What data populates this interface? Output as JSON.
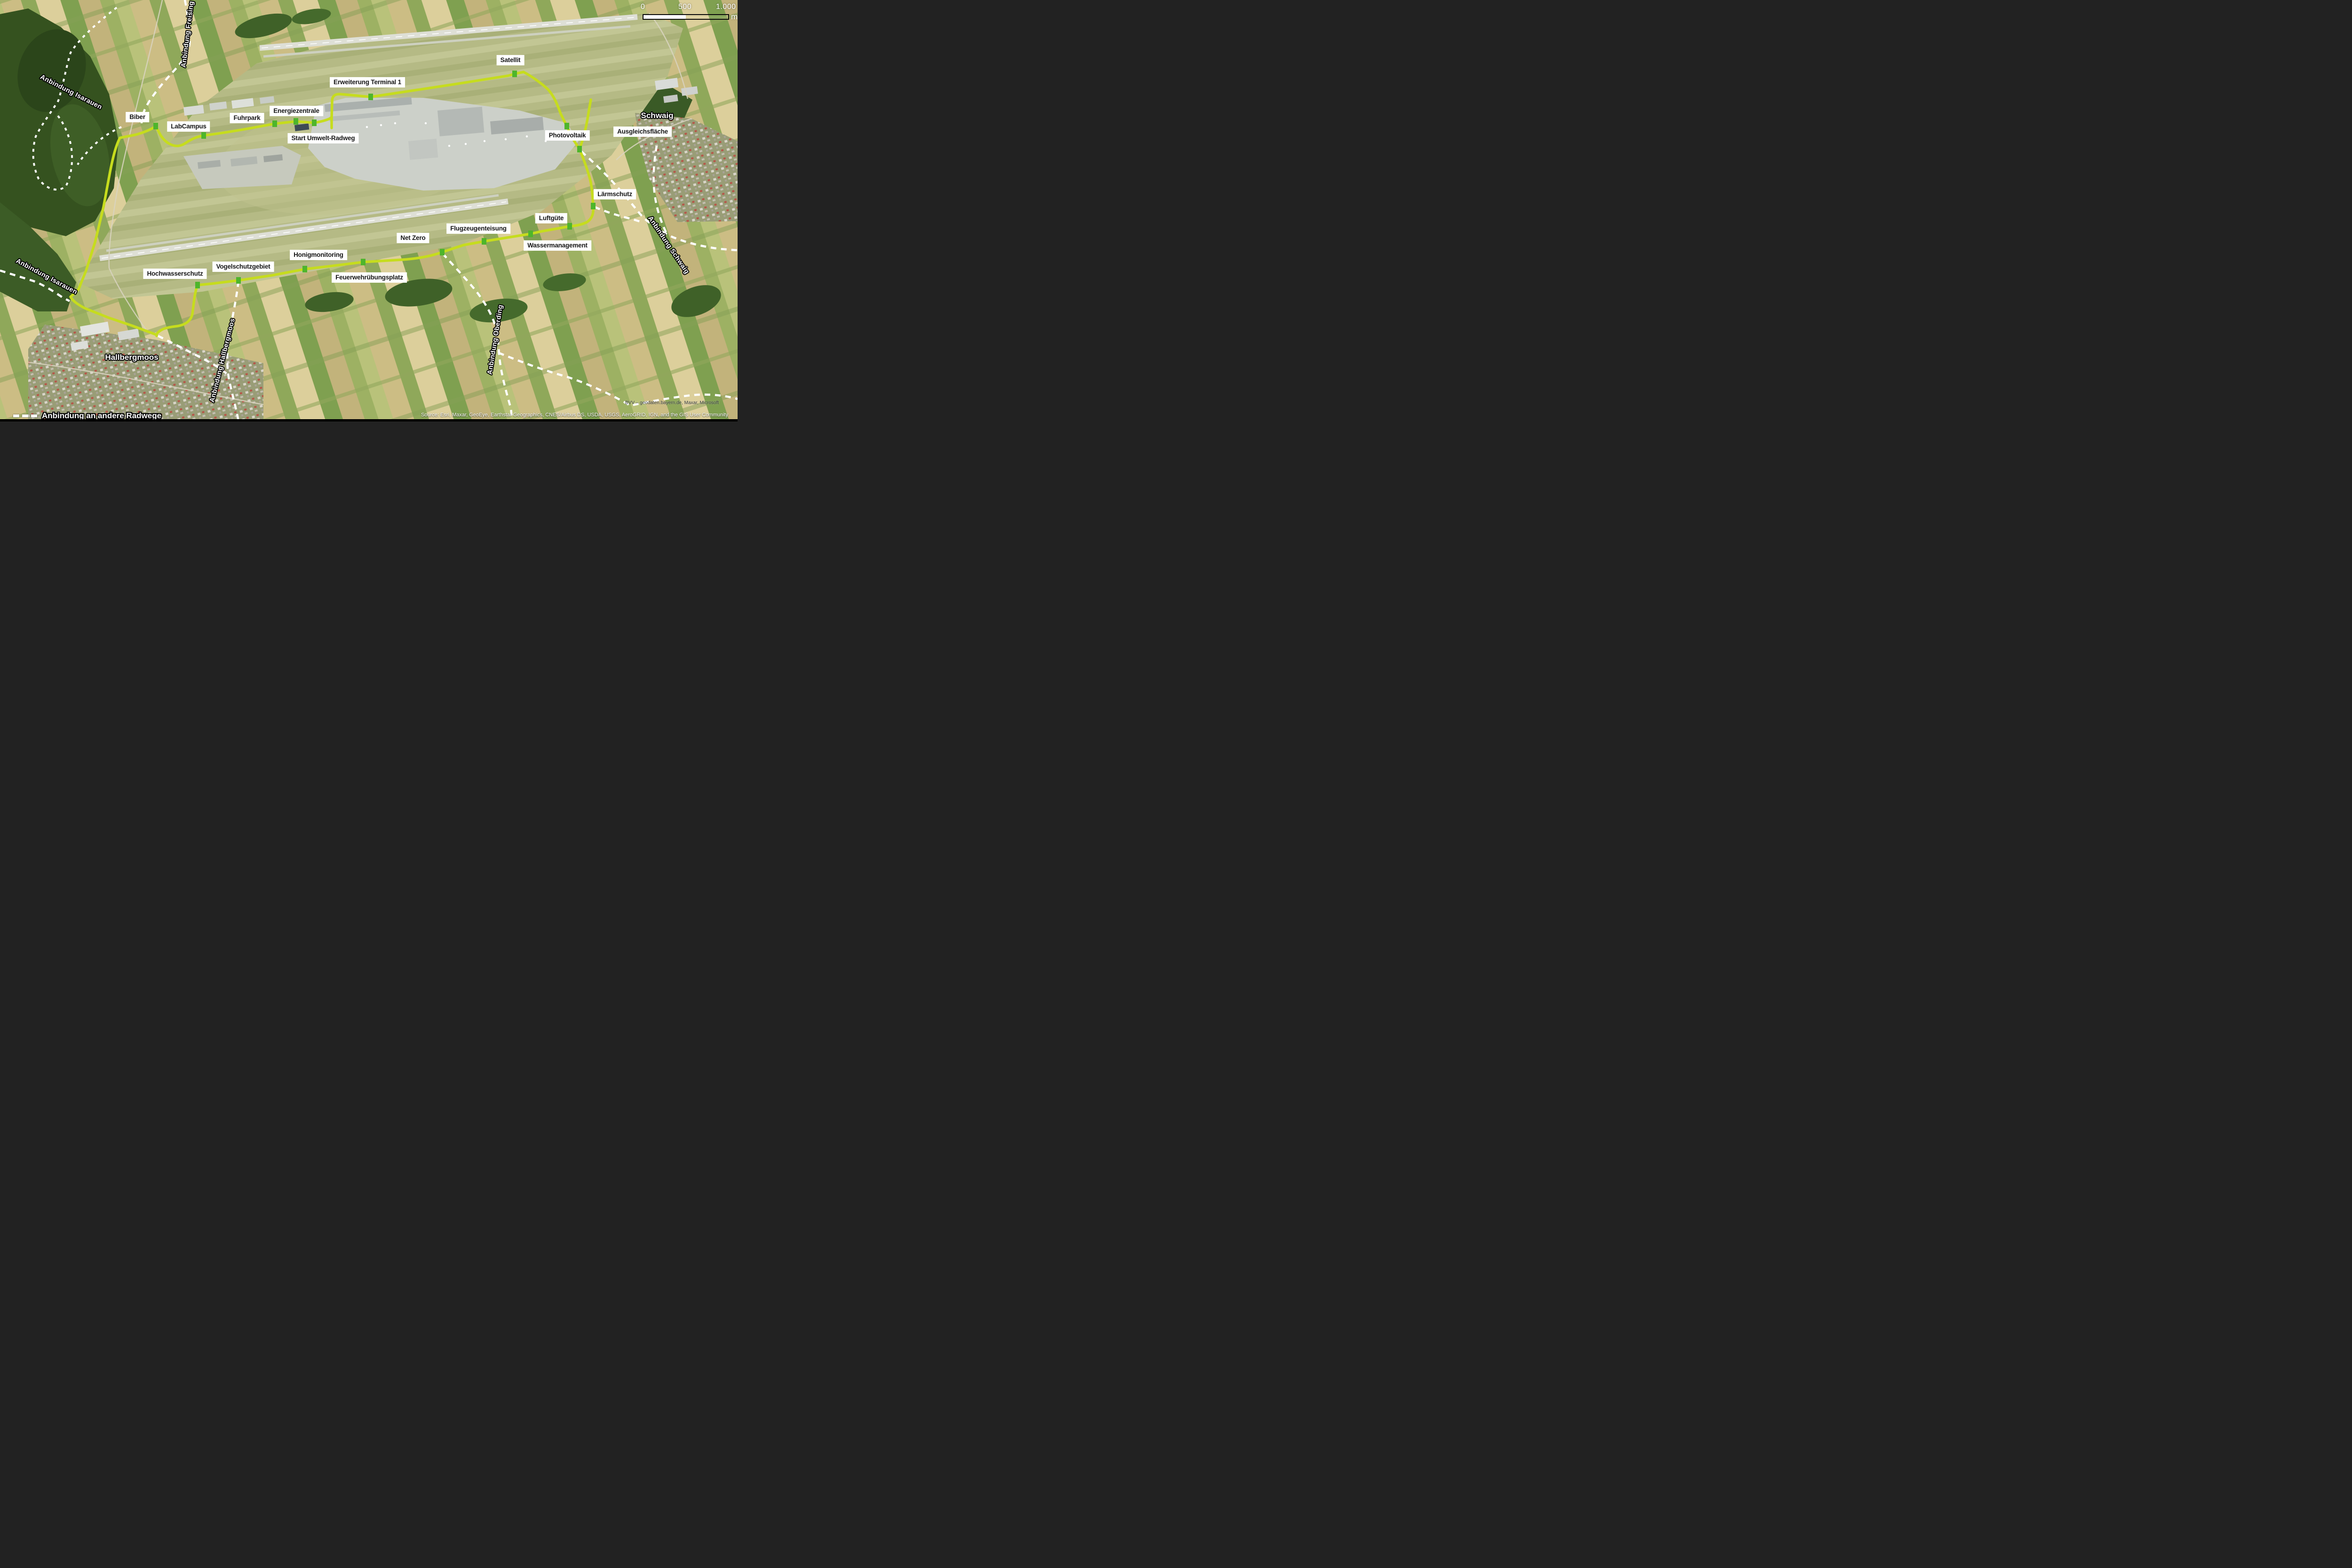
{
  "map": {
    "scale_bar": {
      "tick_0": "0",
      "tick_mid": "500",
      "tick_end": "1.000",
      "unit": "m"
    },
    "legend_other_routes": "Anbindung an andere Radwege",
    "attribution_imagery": "BVV – geodaten.bayern.de, Maxar, Microsoft",
    "attribution_source": "Source: Esri, Maxar, GeoEye, Earthstar Geographics, CNES/Airbus DS, USDA, USGS, AeroGRID, IGN, and the GIS User Community",
    "colors": {
      "route_green": "#c6dc1e",
      "marker_green": "#4eb52c",
      "connection_dash": "#ffffff"
    }
  },
  "stations": [
    {
      "label": "Biber"
    },
    {
      "label": "LabCampus"
    },
    {
      "label": "Fuhrpark"
    },
    {
      "label": "Energiezentrale"
    },
    {
      "label": "Start Umwelt-Radweg"
    },
    {
      "label": "Erweiterung Terminal 1"
    },
    {
      "label": "Satellit"
    },
    {
      "label": "Photovoltaik"
    },
    {
      "label": "Ausgleichsfläche"
    },
    {
      "label": "Lärmschutz"
    },
    {
      "label": "Luftgüte"
    },
    {
      "label": "Wassermanagement"
    },
    {
      "label": "Flugzeugenteisung"
    },
    {
      "label": "Net Zero"
    },
    {
      "label": "Feuerwehrübungsplatz"
    },
    {
      "label": "Honigmonitoring"
    },
    {
      "label": "Vogelschutzgebiet"
    },
    {
      "label": "Hochwasserschutz"
    }
  ],
  "connections": [
    {
      "label": "Anbindung Freising"
    },
    {
      "label": "Anbindung Isarauen"
    },
    {
      "label": "Anbindung Isarauen"
    },
    {
      "label": "Anbindung Hallbergmoos"
    },
    {
      "label": "Anbindung Oberding"
    },
    {
      "label": "Anbindung Schwaig"
    }
  ],
  "places": [
    {
      "name": "Schwaig"
    },
    {
      "name": "Hallbergmoos"
    }
  ]
}
